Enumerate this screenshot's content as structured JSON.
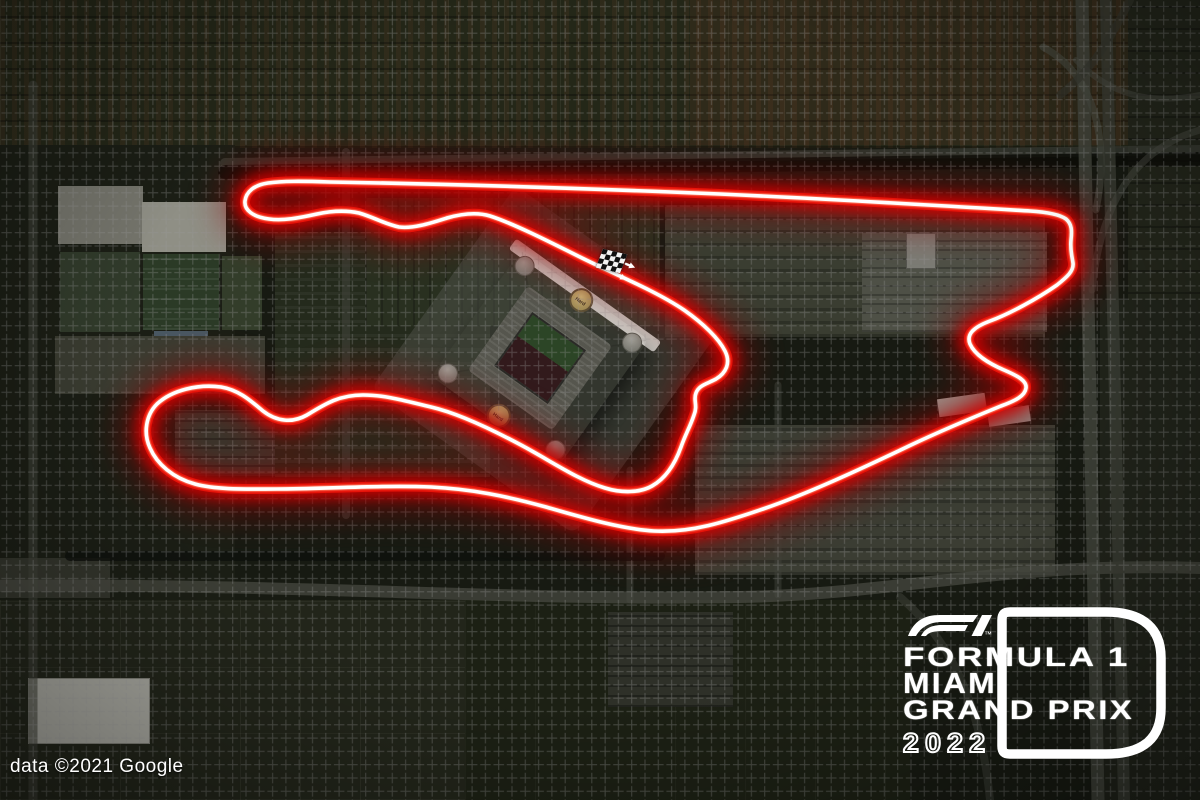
{
  "attribution": {
    "text": "data ©2021 Google"
  },
  "event_logo": {
    "f1_wordmark": "F1",
    "trademark": "™",
    "line1": "FORMULA 1",
    "line2": "MIAMI",
    "line3": "GRAND PRIX",
    "year": "2022"
  },
  "stadium": {
    "roof_logo_text": "Hard Rock"
  },
  "track": {
    "colors": {
      "bloom": "#8f0000",
      "glow": "#d40000",
      "stroke": "#e81309",
      "hot": "#ff7a60",
      "core": "#ffffff"
    },
    "start_finish": {
      "marker": "checkered-flag",
      "direction": "southeast",
      "arrow_count": 2
    }
  }
}
